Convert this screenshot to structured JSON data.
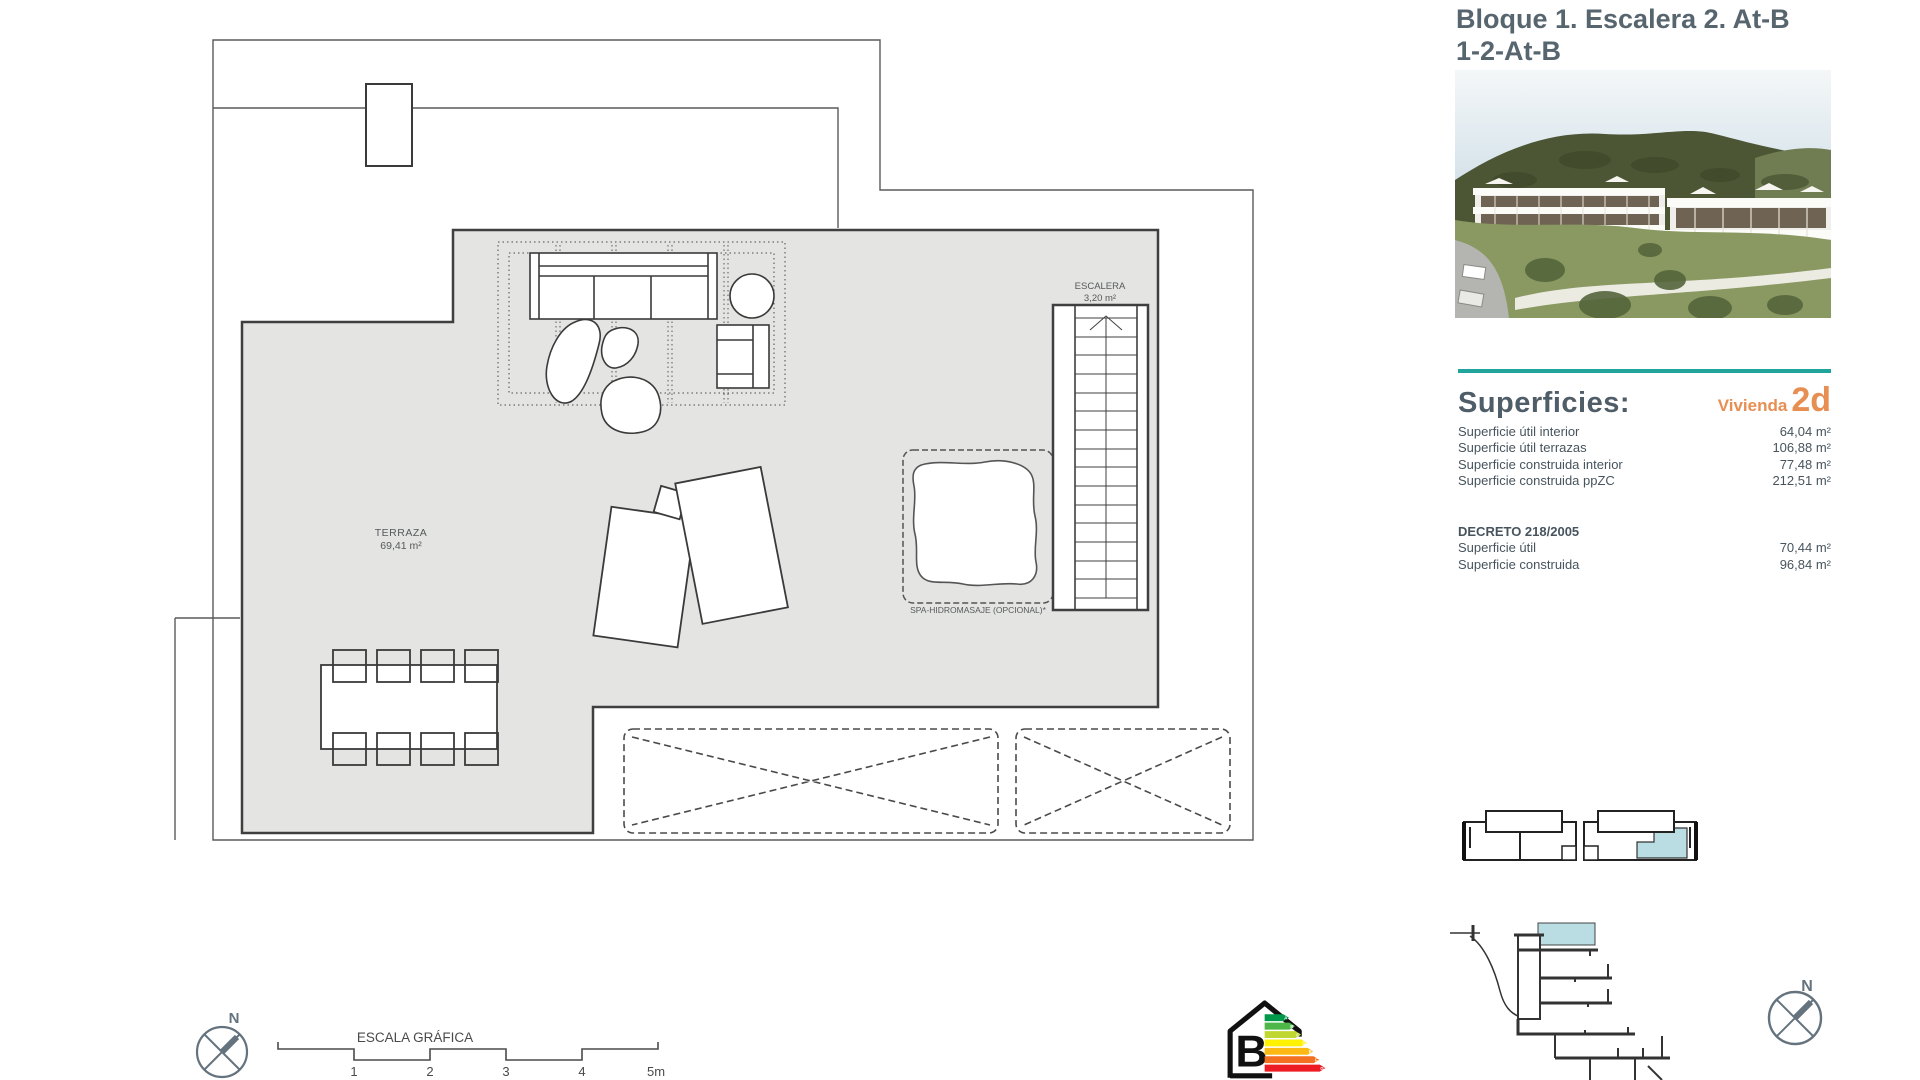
{
  "header": {
    "title_line1": "Bloque 1. Escalera 2. At-B",
    "title_line2": "1-2-At-B"
  },
  "superficies": {
    "heading": "Superficies:",
    "vivienda_label": "Vivienda",
    "vivienda_code": "2d",
    "rows": [
      {
        "label": "Superficie útil interior",
        "value": "64,04 m²"
      },
      {
        "label": "Superficie útil terrazas",
        "value": "106,88 m²"
      },
      {
        "label": "Superficie construida interior",
        "value": "77,48 m²"
      },
      {
        "label": "Superficie construida ppZC",
        "value": "212,51 m²"
      }
    ],
    "decreto": {
      "heading": "DECRETO 218/2005",
      "rows": [
        {
          "label": "Superficie útil",
          "value": "70,44 m²"
        },
        {
          "label": "Superficie construida",
          "value": "96,84 m²"
        }
      ]
    }
  },
  "plan": {
    "terraza_label": "TERRAZA",
    "terraza_area": "69,41 m²",
    "escalera_label": "ESCALERA",
    "escalera_area": "3,20 m²",
    "spa_label": "SPA-HIDROMASAJE (OPCIONAL)*"
  },
  "scale_bar": {
    "title": "ESCALA GRÁFICA",
    "ticks": [
      "1",
      "2",
      "3",
      "4",
      "5m"
    ]
  },
  "compass": {
    "north": "N"
  },
  "energy": {
    "rating": "B",
    "bars": [
      {
        "letter": "A",
        "color": "#00984a"
      },
      {
        "letter": "B",
        "color": "#4db848"
      },
      {
        "letter": "C",
        "color": "#bfd730"
      },
      {
        "letter": "D",
        "color": "#fff200"
      },
      {
        "letter": "E",
        "color": "#fdb913"
      },
      {
        "letter": "F",
        "color": "#f37021"
      },
      {
        "letter": "G",
        "color": "#ed1c24"
      }
    ]
  },
  "colors": {
    "accent_teal": "#21a49b",
    "accent_orange": "#e78e53",
    "highlight_blue": "#b9dde3",
    "plan_gray": "#e4e4e3"
  }
}
